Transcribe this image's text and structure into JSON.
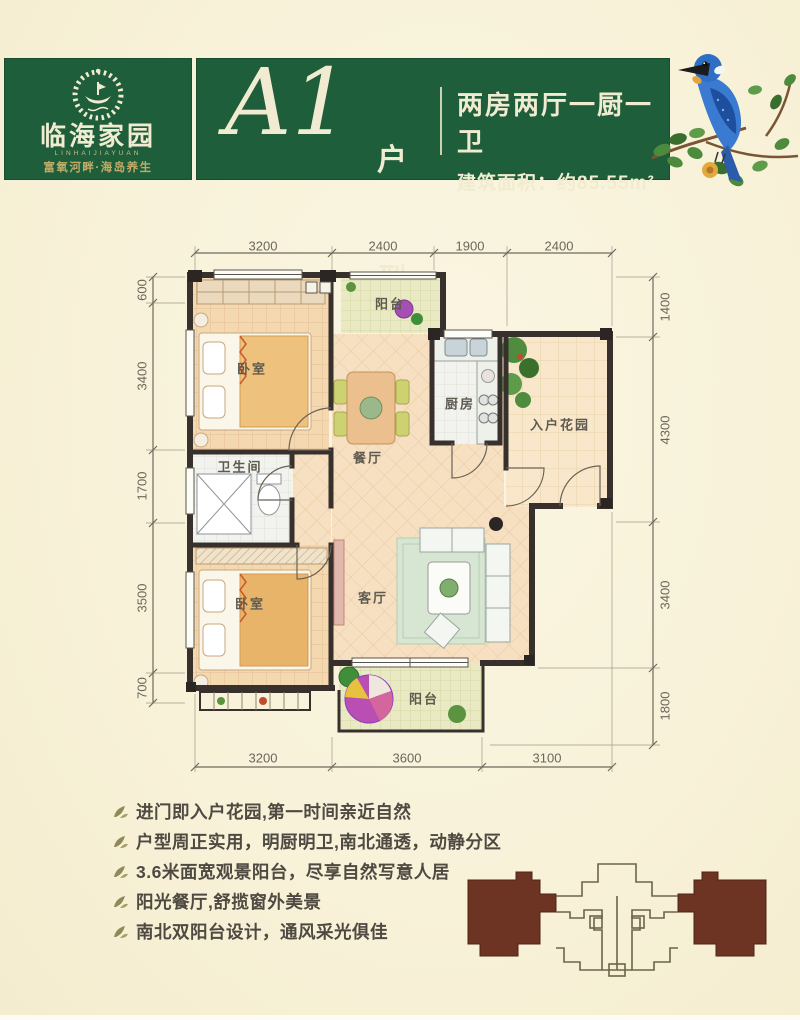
{
  "header": {
    "logo": {
      "name": "临海家园",
      "latin": "LINHAIJIAYUAN",
      "tagline": "富氧河畔·海岛养生"
    },
    "unit": {
      "code": "A1",
      "suffix": "户型"
    },
    "specs": {
      "rooms": "两房两厅一厨一卫",
      "area": "建筑面积：约85.55m²"
    },
    "colors": {
      "green": "#1e5e3a",
      "cream": "#f1ecd1"
    }
  },
  "floorplan": {
    "rooms": [
      {
        "id": "bedroom-1",
        "label": "卧室"
      },
      {
        "id": "balcony-north",
        "label": "阳台"
      },
      {
        "id": "kitchen",
        "label": "厨房"
      },
      {
        "id": "entry-garden",
        "label": "入户花园"
      },
      {
        "id": "dining",
        "label": "餐厅"
      },
      {
        "id": "bathroom",
        "label": "卫生间"
      },
      {
        "id": "bedroom-2",
        "label": "卧室"
      },
      {
        "id": "living",
        "label": "客厅"
      },
      {
        "id": "balcony-south",
        "label": "阳台"
      }
    ],
    "dimensions": {
      "top": [
        "3200",
        "2400",
        "1900",
        "2400"
      ],
      "bottom": [
        "3200",
        "3600",
        "3100"
      ],
      "left": [
        "600",
        "3400",
        "1700",
        "3500",
        "700"
      ],
      "right": [
        "1400",
        "4300",
        "3400",
        "1800"
      ]
    },
    "wall_color": "#38302c"
  },
  "features": {
    "items": [
      "进门即入户花园,第一时间亲近自然",
      "户型周正实用，明厨明卫,南北通透，动静分区",
      "3.6米面宽观景阳台，尽享自然写意人居",
      "阳光餐厅,舒揽窗外美景",
      "南北双阳台设计，通风采光俱佳"
    ]
  },
  "keyplan": {
    "highlight_color": "#6e3423"
  }
}
